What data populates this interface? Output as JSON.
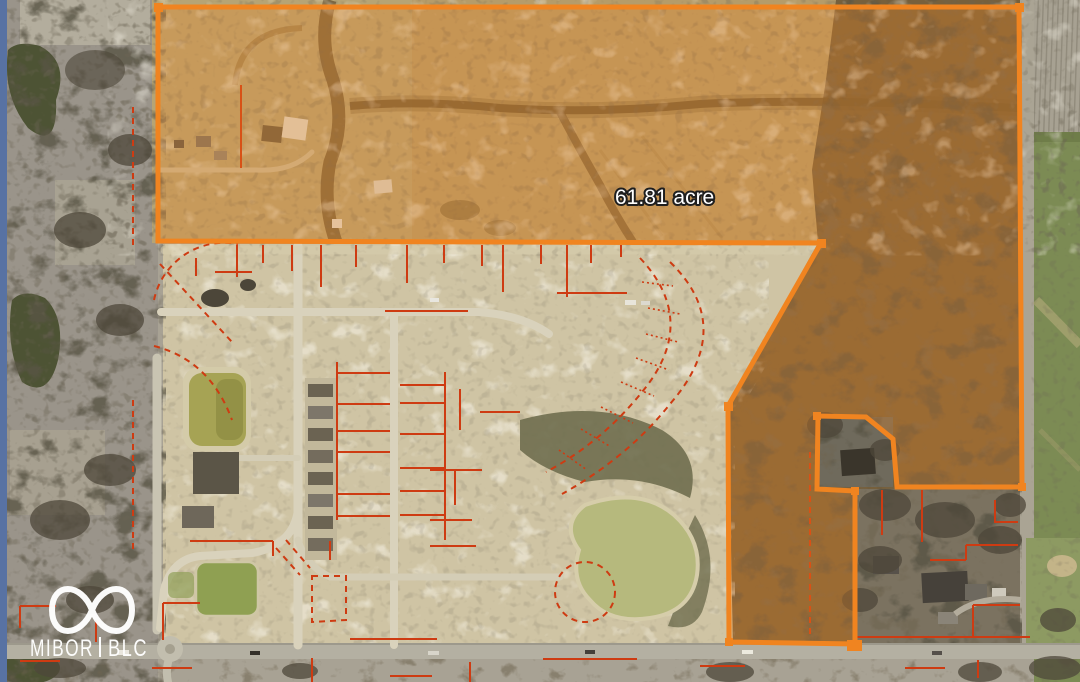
{
  "annotation": {
    "area_label": "61.81 acre"
  },
  "watermark": {
    "brand_primary": "MIBOR",
    "brand_secondary": "BLC",
    "logo": "infinity-icon"
  },
  "palette": {
    "boundary_orange": "#F08420",
    "lot_line_red": "#CE3B12",
    "label_text": "#FFFFFF",
    "label_halo": "#1F1F1F",
    "watermark_white": "#FFFFFF",
    "edge_strip_blue": "#5872A3"
  }
}
